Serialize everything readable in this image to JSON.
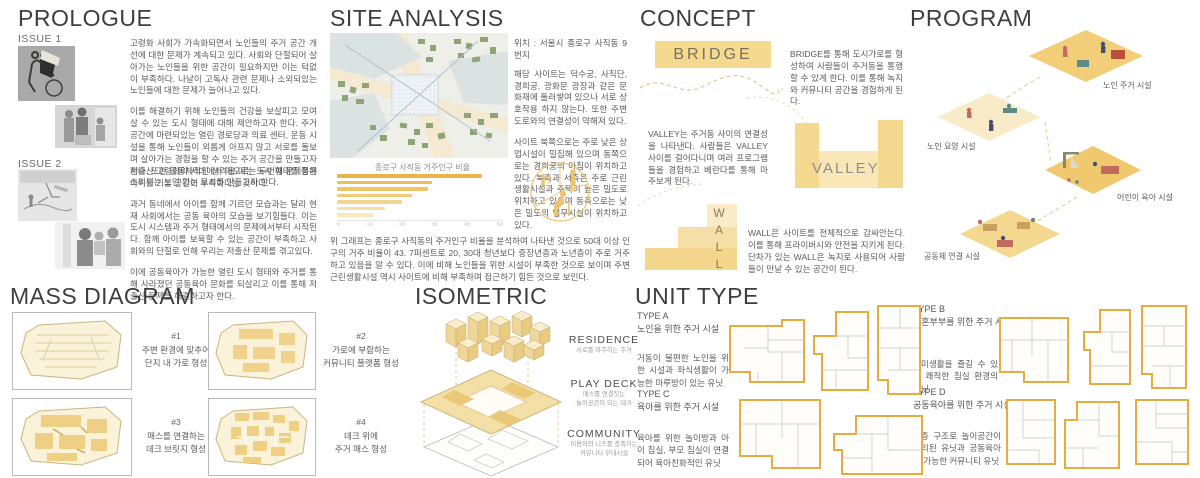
{
  "colors": {
    "accent_yellow": "#F0CD7A",
    "band_yellow": "#F5D98E",
    "bar_dark": "#E8B54A",
    "text_gray": "#5A5A5A",
    "map_green": "#8CA476",
    "map_block": "#DBE2E2"
  },
  "prologue": {
    "title": "PROLOGUE",
    "issue1_label": "ISSUE 1",
    "issue2_label": "ISSUE 2",
    "issue1_p1": "고령화 사회가 가속화되면서 노인들의 주거 공간 개선에 대한 문제가 계속되고 있다. 사회와 단절되어 살아가는 노인들을 위한 공간이 필요하지만 이는 턱없이 부족하다. 나날이 고독사 관련 문제나 소외되있는 노인들에 대한 문제가 늘어나고 있다.",
    "issue1_p2": "이를 해결하기 위해 노인들의 건강을 보살피고 모여살 수 있는 도시 형태에 대해 제안하고자 한다. 주거 공간에 마련되있는 열린 경로당과 의료 센터, 운동 시설을 통해 노인들이 외롭게 아프지 않고 서로를 돌보며 살아가는 경험을 할 수 있는 주거 공간을 만들고자 한다. 또한 공동체적인 성격을 띠는 도시 형태를 통해 소외되는 노인 없는 도시를 만들고자 한다.",
    "issue2_p1": "저출산 고령화의 시대에서 떠오르는 두번째 문제점은 아이를 기를 공간이 부족하다는 것이다.",
    "issue2_p2": "과거 동네에서 아이를 함께 기르던 모습과는 달리 현재 사회에서는 공동 육아의 모습을 보기힘들다. 이는 도시 시스템과 주거 형태에서의 문제에서부터 시작된다. 함께 아이를 보육할 수 있는 공간이 부족하고 사회와의 단절로 인해 우리는 저출산 문제를 겪고있다.",
    "issue2_p3": "이에 공동육아가 가능한 열린 도시 형태와 주거를 통해 사라졌던 공동육아 문화를 되살리고 이를 통해 저출산 문제를 해결하고자 한다."
  },
  "site_analysis": {
    "title": "SITE ANALYSIS",
    "location": "위치 : 서울시 종로구 사직동 9번지",
    "p1": "해당 사이트는 덕수궁, 사직단, 경희궁, 광화문 광장과 같은 문화재에 둘러쌓여 있으나 서로 상호작용 하지 않는다. 또한 주변 도로와의 연결성이 약해져 있다.",
    "p2": "사이트 북쪽으로는 주로 낮은 상업시설이 밀집해 있으며 동쪽으로는 경희궁의 아침이 위치하고 있다. 북측과 서측은 주로 근린생활시설과 주택이 높은 밀도로 위치하고 있으며 동측으로는 낮은 밀도의 업무시설이 위치하고 있다.",
    "chart_note": "위 그래프는 종로구 사직동의 주거인구 비율을 분석하여 나타낸 것으로 50대 이상 인구의 거주 비율이 43. 7퍼센트로 20, 30대 청년보다 중장년층과 노년층이 주로 거주하고 있음을 알 수 있다. 이에 비해 노인들을 위한 시설이 부족한 것으로 보이며 주변 근린생활시설 역시 사이트에 비해 부족하며 접근하기 힘든 것으로 보인다."
  },
  "chart_data": {
    "type": "bar",
    "orientation": "horizontal",
    "title": "종로구 사직동 거주인구 비율",
    "categories": [
      "",
      "",
      "",
      "",
      "",
      "",
      ""
    ],
    "values": [
      43.7,
      28.5,
      27.5,
      22.5,
      19.5,
      14.5,
      11
    ],
    "xlabel": "",
    "ylabel": "",
    "xlim": [
      0,
      50
    ],
    "x_ticks": [
      0,
      10,
      20,
      30,
      40,
      50
    ],
    "grid": false,
    "bar_colors": [
      "#E8B54A",
      "#ECBE5C",
      "#EEC468",
      "#F0CC79",
      "#F3D58E",
      "#F6DFA4",
      "#F9E9BC"
    ]
  },
  "concept": {
    "title": "CONCEPT",
    "bridge": {
      "label": "BRIDGE",
      "text": "BRIDGE를 통해 도시가로를 형성하여 사람들이 주거동을 통행할 수 있게 한다. 이를 통해 녹지와 커뮤니티 공간을 경험하게 된다."
    },
    "valley": {
      "label": "VALLEY",
      "text": "VALLEY는 주거동 사이의 연결성을 나타낸다. 사람들은 VALLEY 사이를 걸어다니며 여러 프로그램들을 경험하고 베란다를 통해 마주보게 된다."
    },
    "wall": {
      "label": "WALL",
      "text": "WALL은 사이트를 전체적으로 감싸안는다. 이를 통해 프라이버시와 안전을 지키게 된다. 단차가 있는 WALL은 녹지로 사용되어 사람들이 만날 수 있는 공간이 된다."
    }
  },
  "program": {
    "title": "PROGRAM",
    "tiles": [
      {
        "label": "노인 주거 시설"
      },
      {
        "label": "노인 요양 시설"
      },
      {
        "label": "어린이 육아 시설"
      },
      {
        "label": "공동체 연결 시설"
      }
    ]
  },
  "mass_diagram": {
    "title": "MASS DIAGRAM",
    "items": [
      {
        "num": "#1",
        "line1": "주변 환경에 맞추어",
        "line2": "단지 내 가로 형성"
      },
      {
        "num": "#2",
        "line1": "가로에 부합하는",
        "line2": "커뮤니티 플랫폼 형성"
      },
      {
        "num": "#3",
        "line1": "매스를 연결하는",
        "line2": "데크 브릿지 형성"
      },
      {
        "num": "#4",
        "line1": "데크 위에",
        "line2": "주거 매스 형성"
      }
    ]
  },
  "isometric": {
    "title": "ISOMETRIC",
    "layers": [
      {
        "label": "RESIDENCE",
        "sub1": "서로를 마주하는 주거",
        "sub2": ""
      },
      {
        "label": "PLAY DECK",
        "sub1": "매스를 연결짓는",
        "sub2": "놀이공간이 되는 데크"
      },
      {
        "label": "COMMUNITY",
        "sub1": "이용자의 니즈를 충족하는",
        "sub2": "커뮤니티 부대시설"
      }
    ]
  },
  "unit_type": {
    "title": "UNIT TYPE",
    "types": [
      {
        "name": "TYPE A",
        "subtitle": "노인을 위한 주거 시설",
        "desc": "거동이 불편한 노인을 위한 시설과 좌식생활이 가능한 마루방이 있는 유닛"
      },
      {
        "name": "TYPE B",
        "subtitle": "신혼부부를 위한 주거 시설",
        "desc": "취미생활을 즐길 수 있고 쾌적한 침실 환경의 유닛"
      },
      {
        "name": "TYPE C",
        "subtitle": "육아를 위한 주거 시설",
        "desc": "육아를 위한 놀이방과 아이 침실, 부모 침실이 연결되어 육아친화적인 유닛"
      },
      {
        "name": "TYPE D",
        "subtitle": "공동육아를 위한 주거 시설",
        "desc": "복층 구조로 놀이공간이 분리된 유닛과 공동육아가 가능한 커뮤니티 유닛"
      }
    ]
  }
}
